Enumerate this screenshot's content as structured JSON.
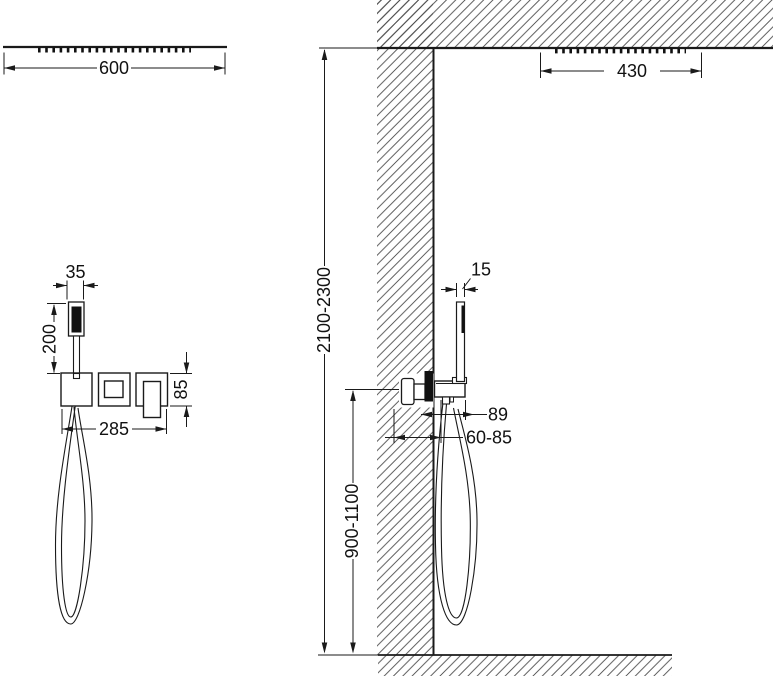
{
  "drawing": {
    "type": "shower-system-installation-diagram",
    "front_view": {
      "ceiling_shower_width": "600",
      "hand_shower_width": "35",
      "hand_shower_height": "200",
      "plate_height": "85",
      "trim_width": "285"
    },
    "side_view": {
      "ceiling_shower_width": "430",
      "hand_shower_depth": "15",
      "projection": "89",
      "recess_depth": "60-85",
      "mixer_height_range": "900-1100",
      "install_height_range": "2100-2300"
    },
    "colors": {
      "line": "#1a1a1a",
      "hatch": "#4a4a4a",
      "solid_fill": "#111111",
      "background": "#ffffff"
    }
  }
}
